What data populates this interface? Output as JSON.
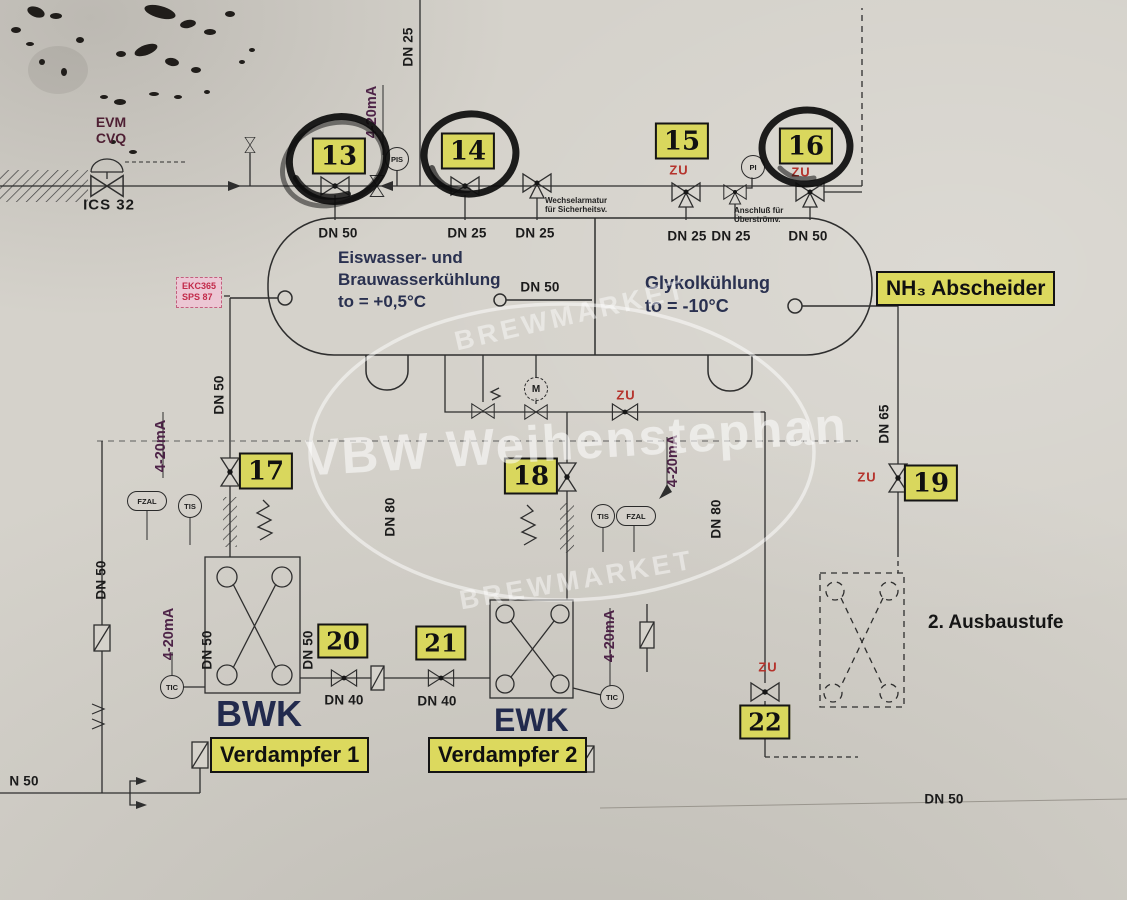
{
  "colors": {
    "paper": "#d5d2cb",
    "line": "#2e2e2e",
    "tag_bg": "#d9d75d",
    "label_bg": "#dcd95e",
    "zu_red": "#b5332c",
    "signal_purple": "#4d2347",
    "vessel_text": "#2a3150",
    "ekc_bg": "#ecc7d4",
    "ekc_text": "#c22a4a",
    "marker_black": "#0c0c0c",
    "watermark_white": "#ffffff"
  },
  "tags": {
    "t13": "13",
    "t14": "14",
    "t15": "15",
    "t16": "16",
    "t17": "17",
    "t18": "18",
    "t19": "19",
    "t20": "20",
    "t21": "21",
    "t22": "22"
  },
  "dn": {
    "dn25": "DN 25",
    "dn40": "DN 40",
    "dn50": "DN 50",
    "dn65": "DN 65",
    "dn80": "DN 80",
    "n50": "N 50"
  },
  "instruments": {
    "pis": "PIS",
    "pi": "PI",
    "tis": "TIS",
    "tic": "TIC",
    "fzal": "FZAL",
    "m": "M"
  },
  "flags": {
    "zu": "ZU"
  },
  "signals": {
    "current_loop": "4-20mA"
  },
  "supply": {
    "evm": "EVM",
    "cvq": "CVQ",
    "ics": "ICS 32"
  },
  "vessel": {
    "left1": "Eiswasser- und",
    "left2": "Brauwasserkühlung",
    "left3": "to = +0,5°C",
    "right1": "Glykolkühlung",
    "right2": "to = -10°C",
    "name": "NH₃ Abscheider"
  },
  "notes": {
    "wechsel1": "Wechselarmatur",
    "wechsel2": "für Sicherheitsv.",
    "anschluss1": "Anschluß für",
    "anschluss2": "Überströmv.",
    "ausbaustufe": "2. Ausbaustufe"
  },
  "controller": {
    "line1": "EKC365",
    "line2": "SPS 87"
  },
  "exchangers": {
    "bwk": "BWK",
    "ewk": "EWK",
    "verdampfer1": "Verdampfer 1",
    "verdampfer2": "Verdampfer 2"
  },
  "watermark": {
    "main": "VBW Weihenstephan",
    "brand": "BREWMARKET"
  }
}
